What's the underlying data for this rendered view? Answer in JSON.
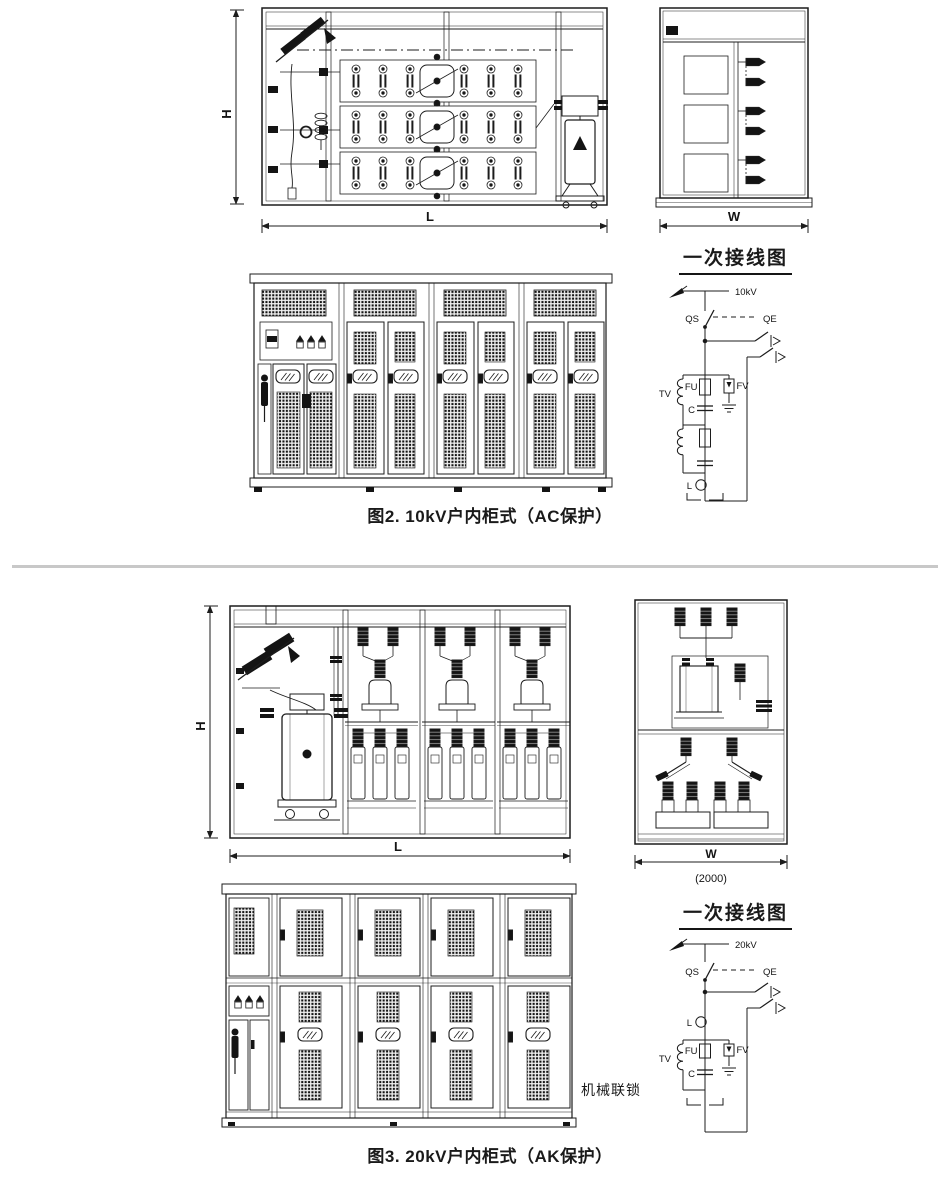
{
  "colors": {
    "line": "#1c1c1c",
    "divider": "#c8c8c8",
    "paper": "#ffffff"
  },
  "figure2": {
    "caption": "图2. 10kV户内柜式（AC保护）",
    "dim_h": "H",
    "dim_l": "L",
    "dim_w": "W",
    "schematic": {
      "title": "一次接线图",
      "voltage": "10kV",
      "qs": "QS",
      "qe": "QE",
      "tv": "TV",
      "fu": "FU",
      "c": "C",
      "fv": "FV",
      "l": "L"
    }
  },
  "figure3": {
    "caption": "图3. 20kV户内柜式（AK保护）",
    "dim_h": "H",
    "dim_l": "L",
    "dim_w": "W",
    "dim_w_value": "(2000)",
    "interlock": "机械联锁",
    "schematic": {
      "title": "一次接线图",
      "voltage": "20kV",
      "qs": "QS",
      "qe": "QE",
      "l": "L",
      "tv": "TV",
      "fu": "FU",
      "c": "C",
      "fv": "FV"
    }
  }
}
